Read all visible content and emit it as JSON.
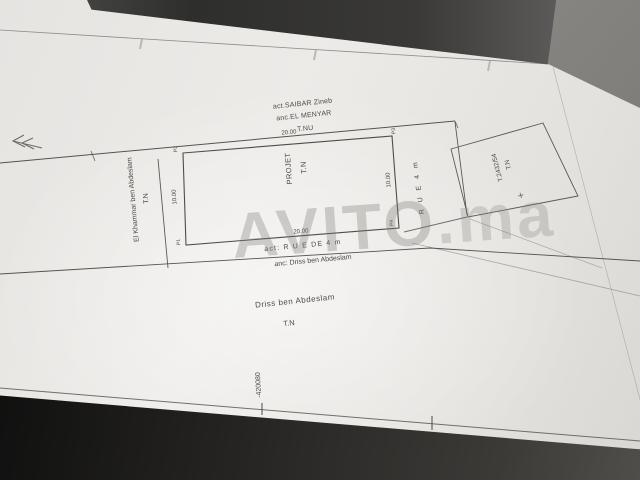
{
  "watermark": {
    "brand": "AVITO",
    "suffix": ".ma"
  },
  "plan": {
    "north_owner": {
      "line1": "act.SAIBAR Zineb",
      "line2": "anc.EL MENYAR",
      "line3": "T.NU"
    },
    "west_parcel": {
      "name": "El Khammar ben Abdeslam",
      "terrain": "T.N"
    },
    "project_parcel": {
      "name": "PROJET",
      "terrain": "T.N",
      "dim_top": "20.00",
      "dim_bottom": "20.00",
      "dim_left": "10.00",
      "dim_right": "10.00",
      "corner_p1": "P1",
      "corner_p2": "P2",
      "corner_p3": "P3",
      "corner_p4": "P4"
    },
    "east_parcel": {
      "title": "T.2432/54",
      "terrain": "T.N",
      "cross": "+"
    },
    "street_east": {
      "label": "R U E  4 m"
    },
    "street_south": {
      "line1": "act: R U E  DE 4 m",
      "line2": "anc: Driss ben Abdeslam"
    },
    "south_owner": {
      "name": "Driss ben Abdeslam",
      "terrain": "T.N"
    },
    "grid": {
      "coord_left": "-420080",
      "coord_right": "-420060"
    }
  },
  "colors": {
    "ink": "#4c4a46",
    "paper": "#edebe8",
    "surface_dark": "#262523",
    "watermark_grey": "#7a7874"
  }
}
